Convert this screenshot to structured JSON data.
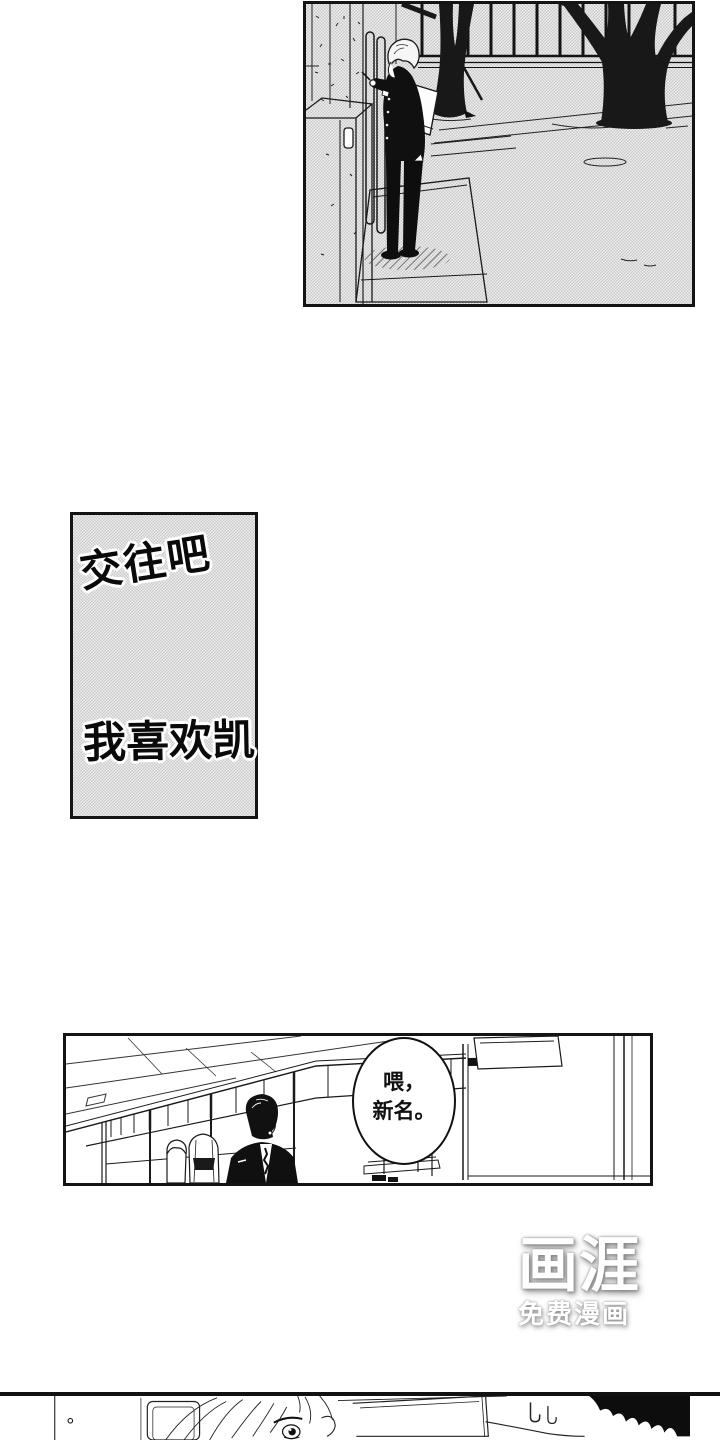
{
  "page": {
    "width": 720,
    "height": 1440,
    "background": "#ffffff"
  },
  "colors": {
    "ink": "#141414",
    "halftone_dark": "#c9c9c9",
    "halftone_light": "#eeeeee",
    "watermark_text": "#ffffff",
    "watermark_glow": "#9a9a9a"
  },
  "panels": {
    "confession": {
      "line1": "交往吧",
      "line2": "我喜欢凯"
    },
    "hallway": {
      "bubble_line1": "喂，",
      "bubble_line2": "新名。"
    }
  },
  "watermark": {
    "logo": "画涯",
    "tagline": "免费漫画"
  }
}
